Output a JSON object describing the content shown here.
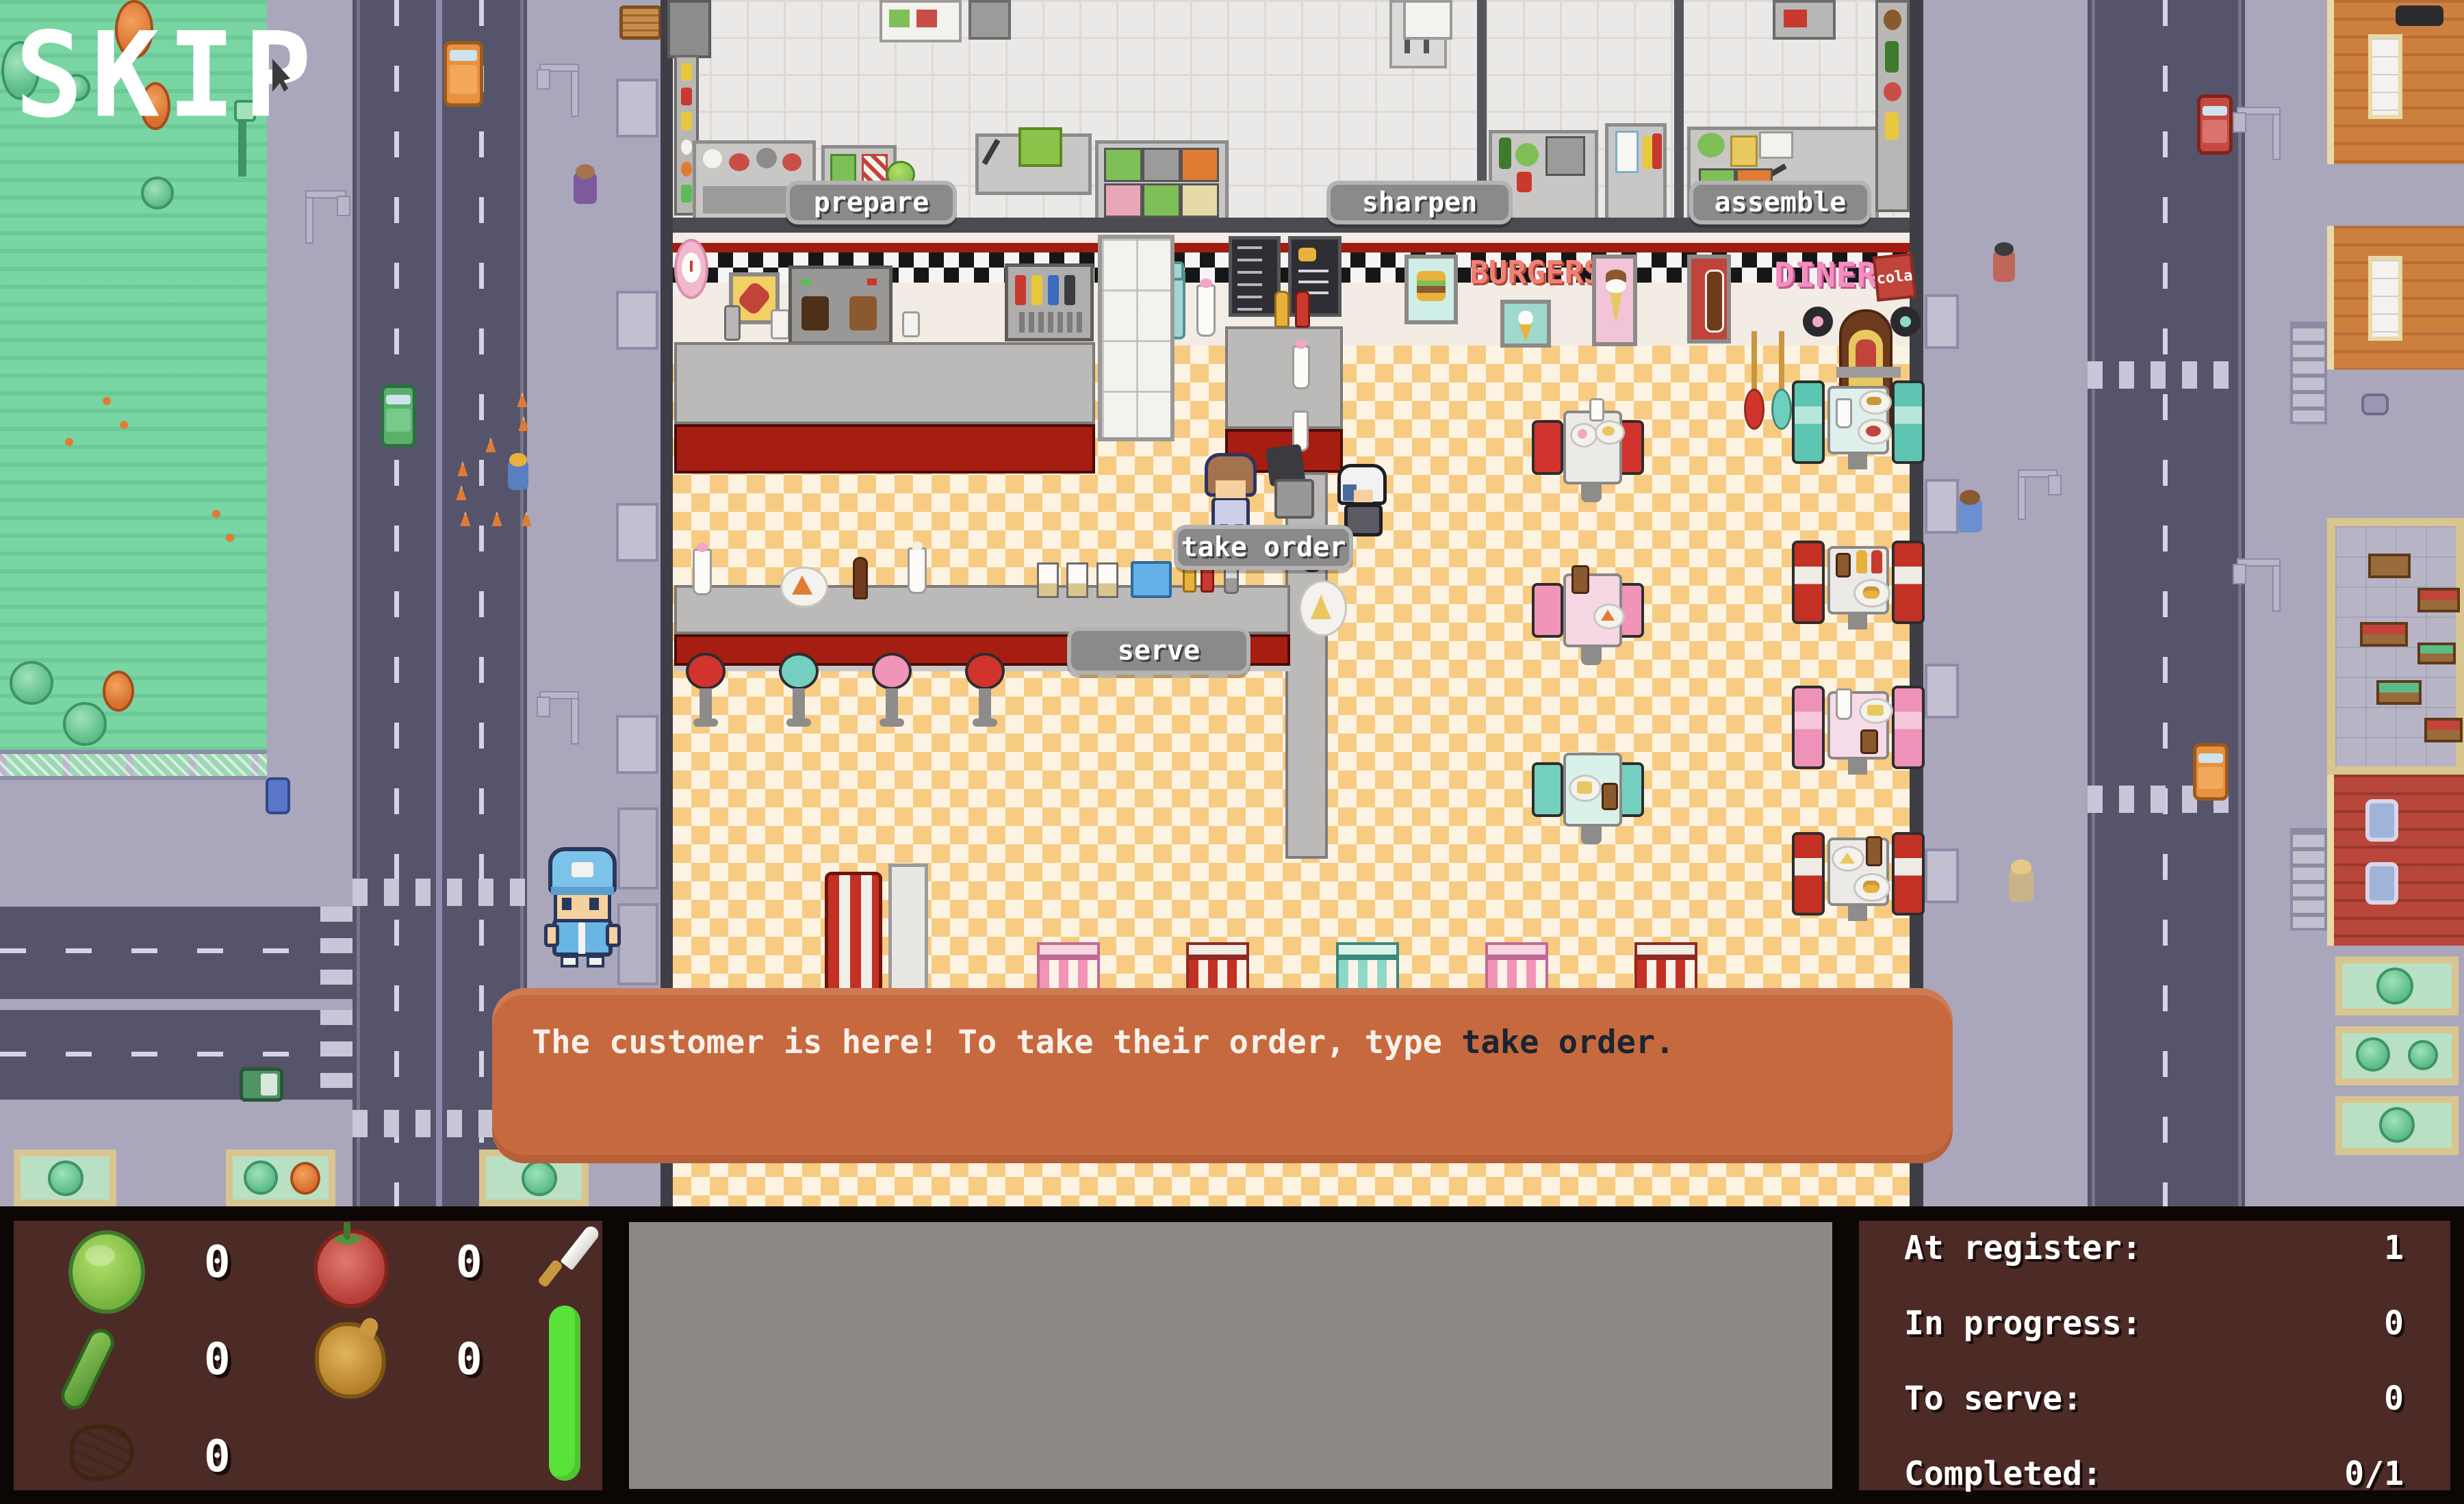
{
  "skip": {
    "label": "SKIP"
  },
  "stations": {
    "prepare": "prepare",
    "sharpen": "sharpen",
    "assemble": "assemble"
  },
  "actions": {
    "take_order": "take order",
    "serve": "serve"
  },
  "dialogue": {
    "message": "The customer is here! To take their order, type ",
    "command": "take order."
  },
  "wall_signs": {
    "burgers": "BURGERS",
    "diner": "DINER",
    "cola": "cola"
  },
  "hud": {
    "ingredients": [
      {
        "icon": "lettuce-icon",
        "count": "0"
      },
      {
        "icon": "tomato-icon",
        "count": "0"
      },
      {
        "icon": "cucumber-icon",
        "count": "0"
      },
      {
        "icon": "onion-icon",
        "count": "0"
      },
      {
        "icon": "meat-icon",
        "count": "0"
      }
    ],
    "tool": {
      "icon": "knife-icon",
      "bar_color": "#58e23a"
    },
    "stats": [
      {
        "label": "At register:",
        "value": "1"
      },
      {
        "label": "In progress:",
        "value": "0"
      },
      {
        "label": "To serve:",
        "value": "0"
      },
      {
        "label": "Completed:",
        "value": "0/1"
      }
    ]
  },
  "colors": {
    "dialogue_bg": "#c7693e",
    "hud_panel_bg": "#4c2a26",
    "counter_red": "#a61d12",
    "floor_dark": "#f7cb81",
    "floor_light": "#fdf3e3"
  }
}
